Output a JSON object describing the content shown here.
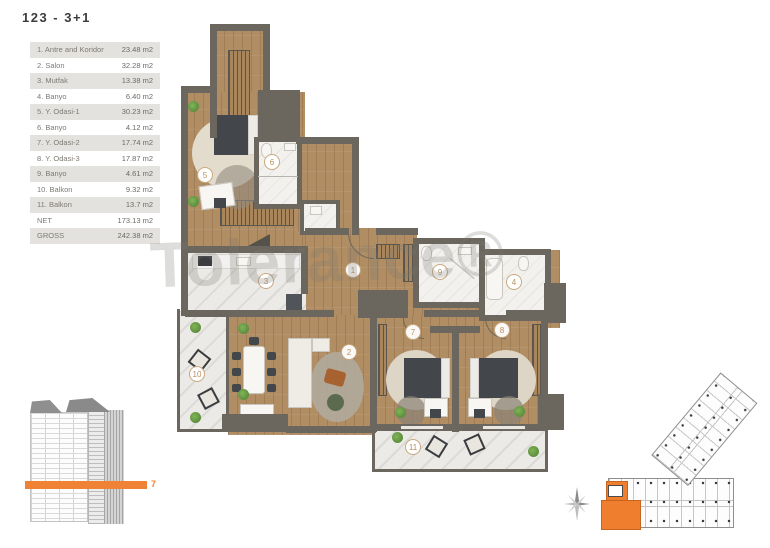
{
  "title": "123 - 3+1",
  "watermark": "Tolerance®",
  "colors": {
    "accent": "#ef7f2e",
    "wall": "#6b665e",
    "wood": "#b18d63",
    "marble": "#ebeae6",
    "badge": "#b9905f"
  },
  "legend": {
    "rows": [
      {
        "label": "1. Antre and Koridor",
        "value": "23.48 m2"
      },
      {
        "label": "2. Salon",
        "value": "32.28 m2"
      },
      {
        "label": "3. Mutfak",
        "value": "13.38 m2"
      },
      {
        "label": "4. Banyo",
        "value": "6.40 m2"
      },
      {
        "label": "5. Y. Odasi-1",
        "value": "30.23 m2"
      },
      {
        "label": "6. Banyo",
        "value": "4.12 m2"
      },
      {
        "label": "7. Y. Odasi-2",
        "value": "17.74 m2"
      },
      {
        "label": "8. Y. Odasi-3",
        "value": "17.87 m2"
      },
      {
        "label": "9. Banyo",
        "value": "4.61 m2"
      },
      {
        "label": "10. Balkon",
        "value": "9.32 m2"
      },
      {
        "label": "11. Balkon",
        "value": "13.7 m2"
      },
      {
        "label": "NET",
        "value": "173.13 m2"
      },
      {
        "label": "GROSS",
        "value": "242.38 m2"
      }
    ]
  },
  "floorplan": {
    "badges": [
      "1",
      "2",
      "3",
      "4",
      "5",
      "6",
      "7",
      "8",
      "9",
      "10",
      "11"
    ]
  },
  "elevation": {
    "floor_label": "7"
  }
}
